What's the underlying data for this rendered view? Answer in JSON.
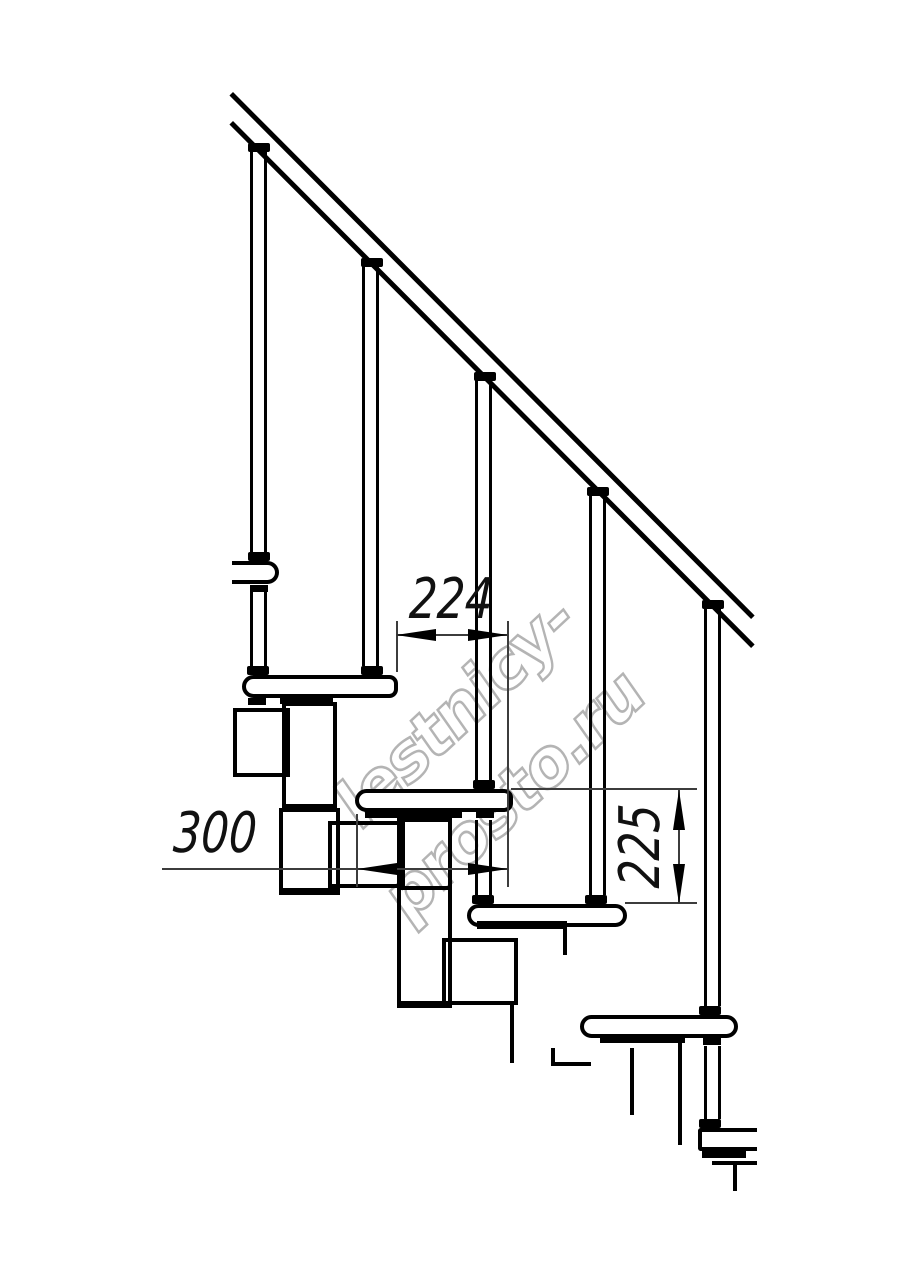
{
  "drawing": {
    "watermark_text": "lestnicy-prosto.ru",
    "dimensions": {
      "tread_run": "224",
      "tread_depth": "300",
      "riser_height": "225"
    },
    "colors": {
      "ink": "#000000",
      "dim_line": "#3c3c3c",
      "watermark": "#b4b4b4",
      "background": "#ffffff"
    }
  }
}
